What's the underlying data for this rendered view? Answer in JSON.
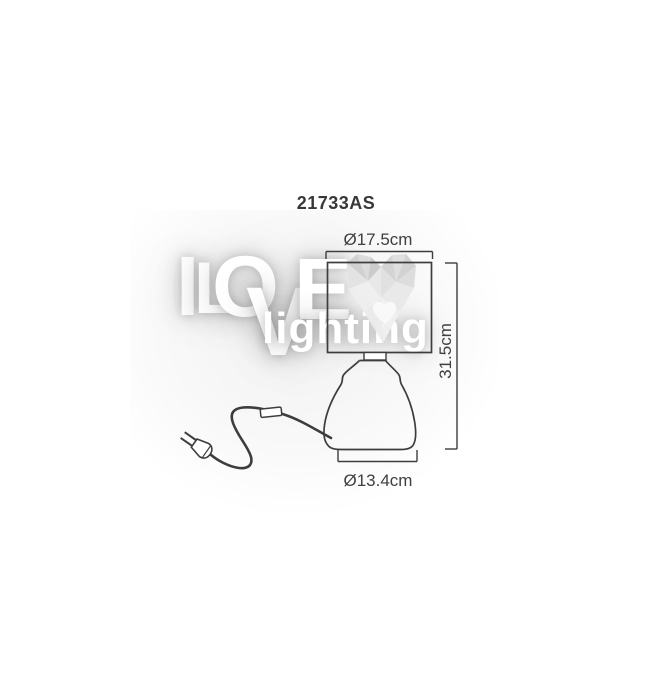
{
  "title": "21733AS",
  "dimensions": {
    "shade_diameter": "Ø17.5cm",
    "height": "31.5cm",
    "base_diameter": "Ø13.4cm"
  },
  "watermark": {
    "letters": [
      "I",
      "L",
      "O",
      "V",
      "E"
    ],
    "subtitle": "lighting"
  },
  "colors": {
    "line_art": "#3d3d3d",
    "label_text": "#3f3f3f",
    "background": "#ffffff",
    "watermark": "#ffffff",
    "heart_gray": "#d6d6d6"
  }
}
